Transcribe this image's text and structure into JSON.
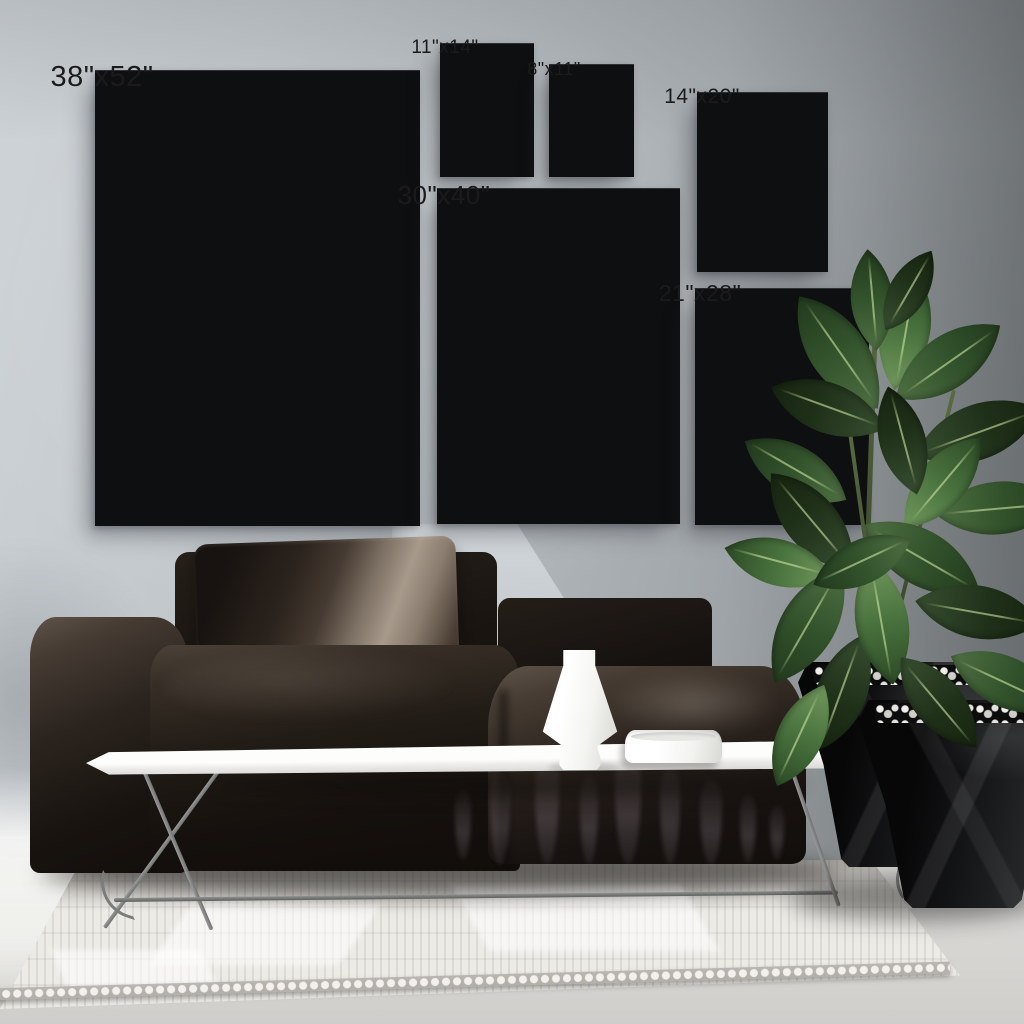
{
  "frames": [
    {
      "id": "frame-38x52",
      "label": "38\"x52\""
    },
    {
      "id": "frame-11x14",
      "label": "11\"x14\""
    },
    {
      "id": "frame-8x11",
      "label": "8\"x11\""
    },
    {
      "id": "frame-14x20",
      "label": "14\"x20\""
    },
    {
      "id": "frame-30x40",
      "label": "30\"x40\""
    },
    {
      "id": "frame-21x28",
      "label": "21\"x28\""
    }
  ],
  "colors": {
    "wall_left": "#ced3d7",
    "wall_right": "#7c8184",
    "floor": "#d4d3d1",
    "rug": "#edebe6",
    "frame_border": "#0e0f11",
    "frame_mat": "#f7f7f5",
    "label_text": "#1b1b1b",
    "sofa": "#221c17",
    "sofa_highlight": "#a79a8b",
    "table": "#fdfdfc",
    "vase": "#ffffff",
    "bowl": "#f7f7f5",
    "plant_leaf": "#31512b",
    "planter": "#131415",
    "pebbles": "#e6e5e2"
  },
  "objects": [
    {
      "name": "gallery-wall-frames"
    },
    {
      "name": "sofa"
    },
    {
      "name": "throw-pillow"
    },
    {
      "name": "coffee-table"
    },
    {
      "name": "vase"
    },
    {
      "name": "bowl"
    },
    {
      "name": "rubber-plant"
    },
    {
      "name": "planter-back"
    },
    {
      "name": "planter-front"
    },
    {
      "name": "area-rug"
    }
  ]
}
